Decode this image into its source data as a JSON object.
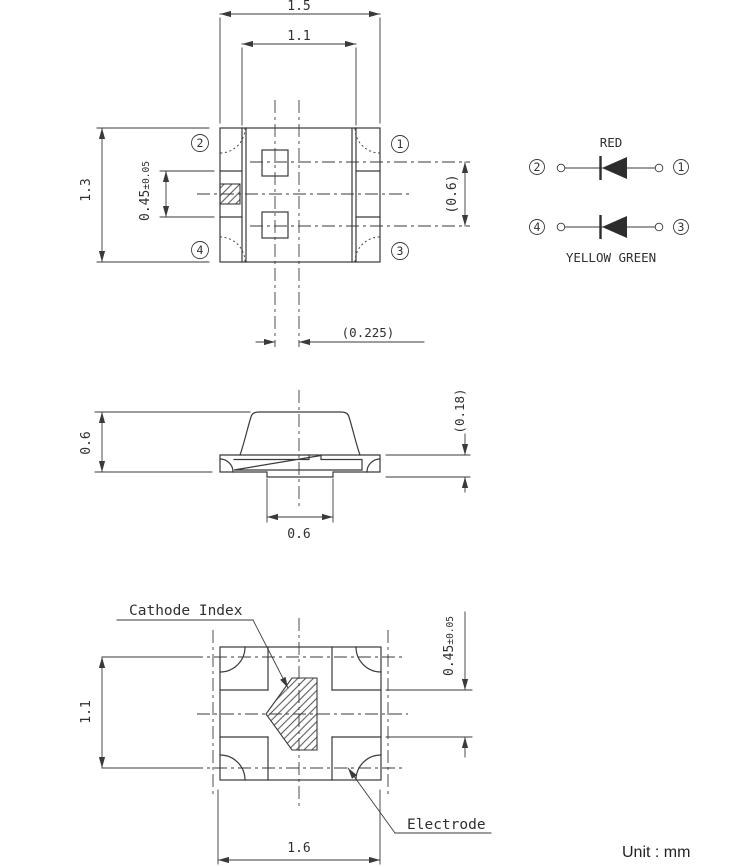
{
  "colors": {
    "line": "#3a3a3a",
    "text": "#303030",
    "background": "#ffffff"
  },
  "unit_note": "Unit : mm",
  "pin_labels": {
    "pin1": "1",
    "pin2": "2",
    "pin3": "3",
    "pin4": "4"
  },
  "top_view": {
    "dim_overall_width": "1.5",
    "dim_inner_width": "1.1",
    "dim_overall_height": "1.3",
    "dim_cathode_mark_height": "0.45",
    "dim_cathode_mark_tol": "±0.05",
    "dim_die_row_pitch": "(0.6)",
    "dim_die_column_offset": "(0.225)"
  },
  "circuit_diagram": {
    "red_led_label": "RED",
    "green_led_label": "YELLOW GREEN"
  },
  "side_view": {
    "dim_height": "0.6",
    "dim_terminal_thickness": "(0.18)",
    "dim_center_pad_width": "0.6"
  },
  "bottom_view": {
    "cathode_index_label": "Cathode Index",
    "electrode_label": "Electrode",
    "dim_pad_row_pitch": "1.1",
    "dim_pad_gap": "0.45",
    "dim_pad_gap_tol": "±0.05",
    "dim_overall_width": "1.6"
  }
}
